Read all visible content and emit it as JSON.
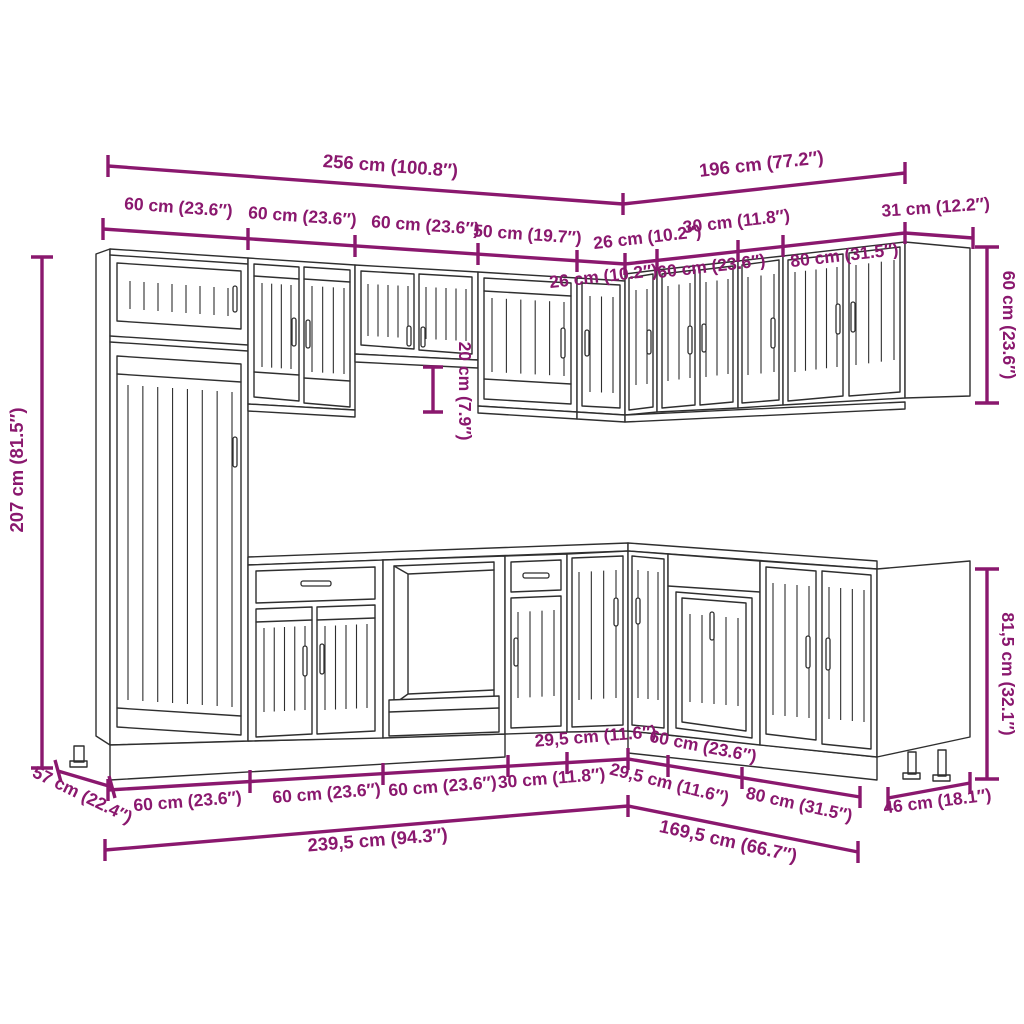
{
  "colors": {
    "dimension_accent": "#8A186E",
    "line_art": "#2F2F2F",
    "background": "#FFFFFF"
  },
  "dims": {
    "top_total_left": "256 cm (100.8″)",
    "top_total_right": "196 cm (77.2″)",
    "wall_run_left": {
      "w1": "60 cm (23.6″)",
      "w2": "60 cm (23.6″)",
      "w3": "60 cm (23.6″)",
      "w4": "50 cm (19.7″)",
      "w5": "26 cm (10.2″)"
    },
    "wall_run_right": {
      "w6": "30 cm (11.8″)",
      "w7": "31 cm (12.2″)",
      "r1": "26 cm (10.2″)",
      "r2": "60 cm (23.6″)",
      "r3": "80 cm (31.5″)"
    },
    "heights": {
      "tall_cabinet": "207 cm (81.5″)",
      "wall_cabinet_right": "60 cm (23.6″)",
      "hood_gap": "20 cm (7.9″)",
      "base_cabinet_right": "81,5 cm (32.1″)"
    },
    "depths": {
      "left": "57 cm (22.4″)",
      "right": "46 cm (18.1″)"
    },
    "base_run_left": {
      "b1": "60 cm (23.6″)",
      "b2": "60 cm (23.6″)",
      "b3": "60 cm (23.6″)",
      "b4": "30 cm (11.8″)",
      "b5": "29,5 cm (11.6″)"
    },
    "base_run_right": {
      "b6": "29,5 cm (11.6″)",
      "b7": "60 cm (23.6″)",
      "b8": "80 cm (31.5″)"
    },
    "base_total_left": "239,5 cm (94.3″)",
    "base_total_right": "169,5 cm (66.7″)"
  }
}
